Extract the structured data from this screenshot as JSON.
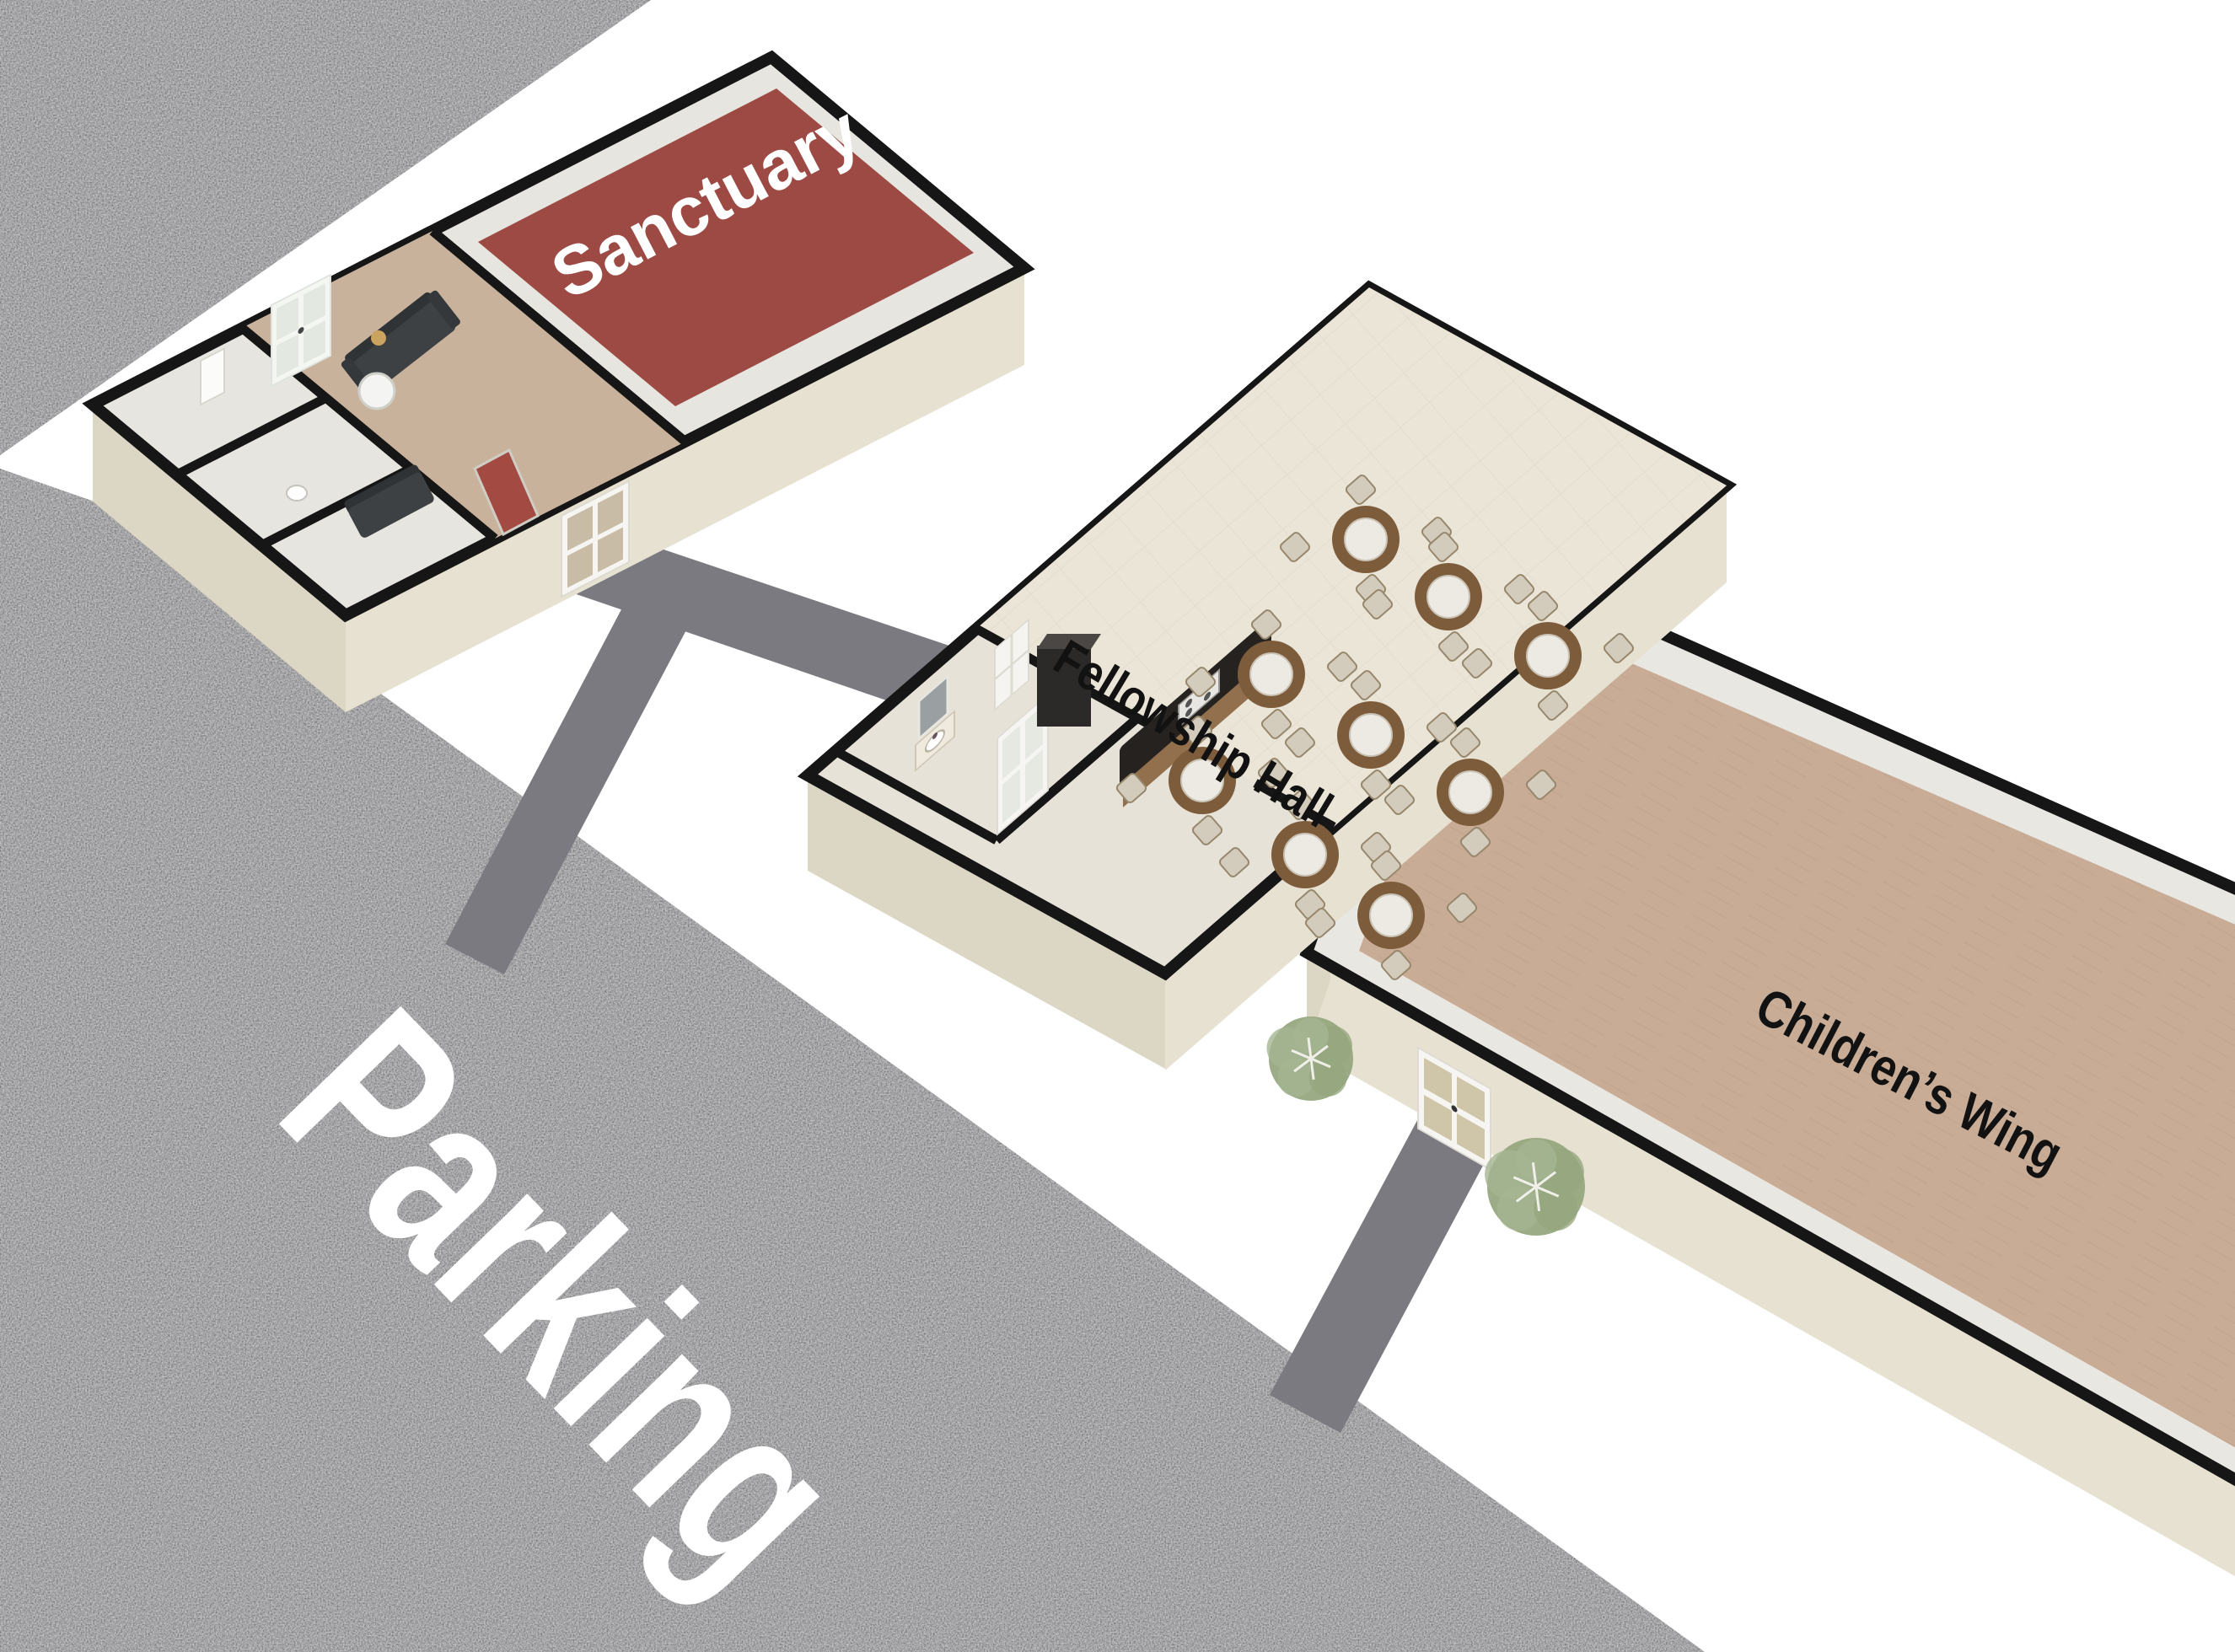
{
  "site": {
    "type": "3d-campus-floor-plan",
    "parking": {
      "label": "Parking"
    },
    "buildings": [
      {
        "id": "sanctuary",
        "label": "Sanctuary"
      },
      {
        "id": "fellowship-hall",
        "label": "Fellowship Hall",
        "round_tables": 9,
        "chairs_per_table": 4
      },
      {
        "id": "childrens-wing",
        "label": "Children’s Wing"
      }
    ],
    "trees": 2,
    "walkways": 3
  },
  "palette": {
    "asphalt": "#575757",
    "walkway": "#7a7a80",
    "wall_line": "#161616",
    "wall_skirt": "#e6e1d0",
    "wall_skirt_dark": "#dcd7c5",
    "sanctuary_carpet": "#9c4a43",
    "lobby_carpet": "#c8b29c",
    "childrens_carpet": "#c9ac95",
    "hall_floor": "#ebe5d7",
    "room_floor": "#e6e5e0",
    "table_wood": "#7d5c3b",
    "table_top": "#edeae3",
    "chair": "#d3ccbc",
    "tree": "#96a880",
    "label_dark": "#121212",
    "label_light": "#ffffff"
  }
}
